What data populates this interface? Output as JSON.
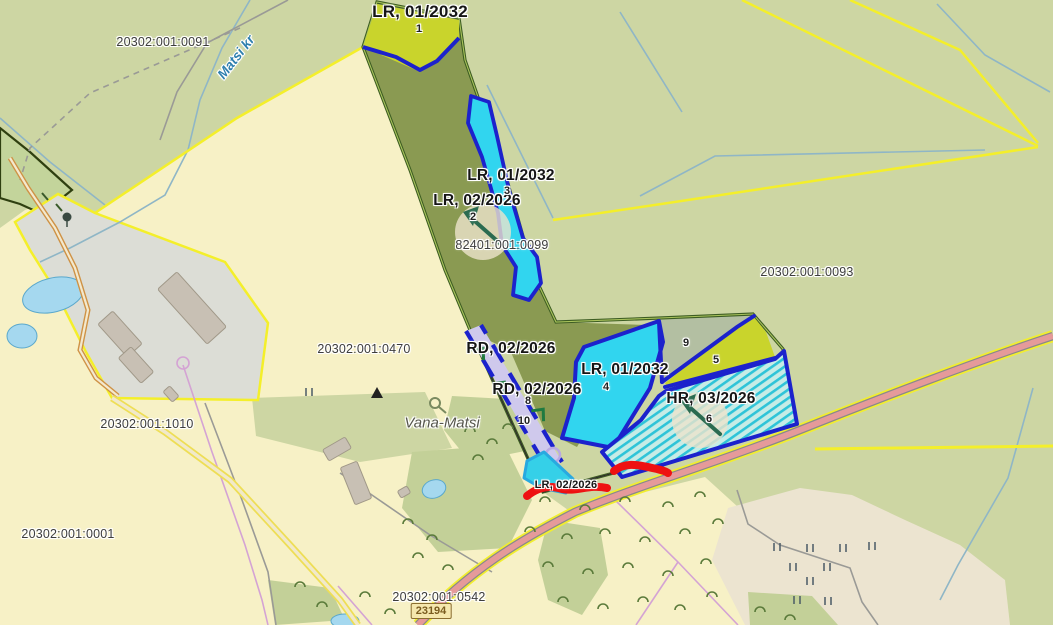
{
  "notifications": [
    {
      "text": "LR, 01/2032"
    },
    {
      "text": "LR, 01/2032"
    },
    {
      "text": "LR, 02/2026"
    },
    {
      "text": "RD, 02/2026"
    },
    {
      "text": "RD, 02/2026"
    },
    {
      "text": "LR, 01/2032"
    },
    {
      "text": "HR, 03/2026"
    },
    {
      "text": "LR, 02/2026"
    }
  ],
  "cadastral": [
    {
      "text": "20302:001:0091"
    },
    {
      "text": "82401:001:0099"
    },
    {
      "text": "20302:001:0093"
    },
    {
      "text": "20302:001:0470"
    },
    {
      "text": "20302:001:1010"
    },
    {
      "text": "20302:001:0001"
    },
    {
      "text": "20302:001:0542"
    }
  ],
  "parcel_numbers": {
    "n1": "1",
    "n2": "2",
    "n3": "3",
    "n4": "4",
    "n5": "5",
    "n6": "6",
    "n8": "8",
    "n9": "9",
    "n10": "10"
  },
  "places": {
    "farm": "Vana-Matsi",
    "stream": "Matsi kr"
  },
  "road": {
    "shield": "23194"
  },
  "colors": {
    "background_forest": "#cdd6a3",
    "field_yellow": "#f7f1c6",
    "overlay_olive": "#8a9a52",
    "overlay_cyan": "#31d5ef",
    "overlay_chartreuse": "#c9d42c",
    "overlay_lavender": "#cfc9ec",
    "border_blue": "#1c22cc",
    "parcel_green": "#3c5c22",
    "cadastral_yellow": "#f4ef2a",
    "road_fill": "#e59a9a",
    "red_mark": "#ee1111",
    "hatch_teal": "#2fc4d8"
  }
}
